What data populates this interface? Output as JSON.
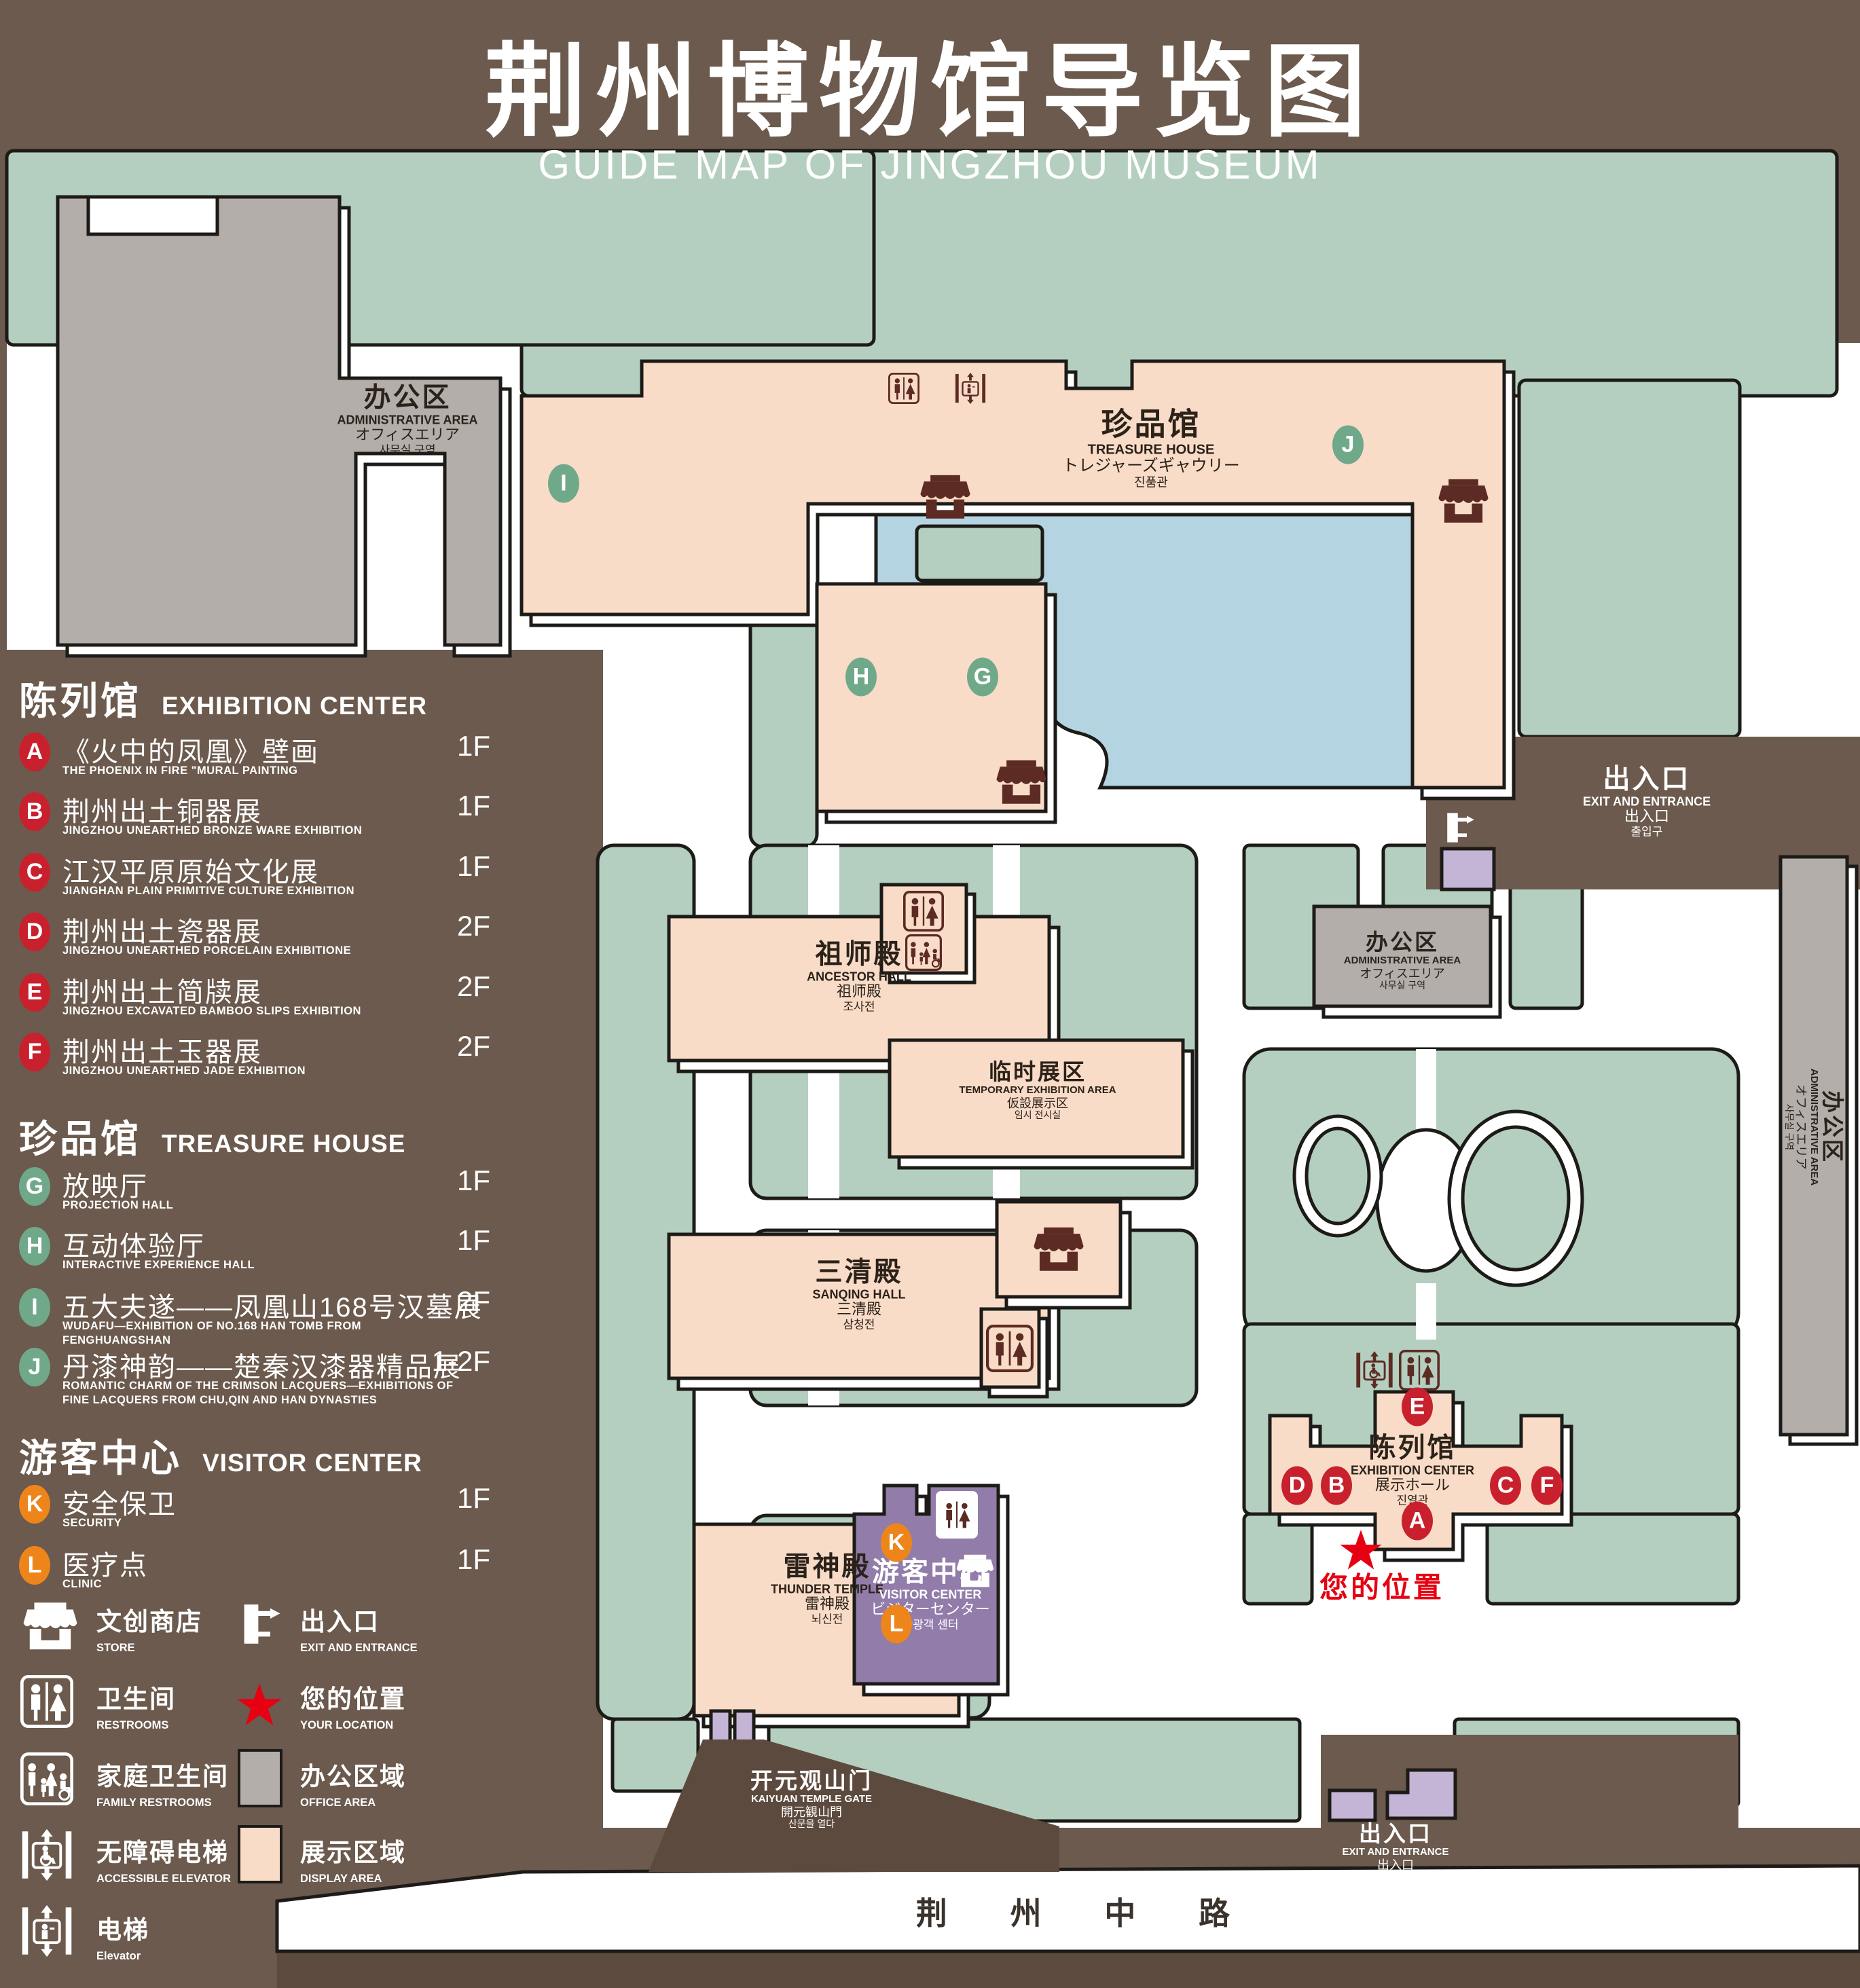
{
  "title": {
    "zh": "荆州博物馆导览图",
    "en": "GUIDE MAP OF JINGZHOU MUSEUM"
  },
  "legend": {
    "sections": [
      {
        "zh": "陈列馆",
        "en": "EXHIBITION CENTER",
        "items": [
          {
            "letter": "A",
            "zh": "《火中的凤凰》壁画",
            "en": "THE PHOENIX IN FIRE \"MURAL PAINTING",
            "floor": "1F"
          },
          {
            "letter": "B",
            "zh": "荆州出土铜器展",
            "en": "JINGZHOU UNEARTHED BRONZE WARE EXHIBITION",
            "floor": "1F"
          },
          {
            "letter": "C",
            "zh": "江汉平原原始文化展",
            "en": "JIANGHAN PLAIN PRIMITIVE CULTURE EXHIBITION",
            "floor": "1F"
          },
          {
            "letter": "D",
            "zh": "荆州出土瓷器展",
            "en": "JINGZHOU UNEARTHED PORCELAIN EXHIBITIONE",
            "floor": "2F"
          },
          {
            "letter": "E",
            "zh": "荆州出土简牍展",
            "en": "JINGZHOU EXCAVATED BAMBOO SLIPS EXHIBITION",
            "floor": "2F"
          },
          {
            "letter": "F",
            "zh": "荆州出土玉器展",
            "en": "JINGZHOU UNEARTHED JADE EXHIBITION",
            "floor": "2F"
          }
        ]
      },
      {
        "zh": "珍品馆",
        "en": "TREASURE HOUSE",
        "items": [
          {
            "letter": "G",
            "zh": "放映厅",
            "en": "PROJECTION HALL",
            "floor": "1F"
          },
          {
            "letter": "H",
            "zh": "互动体验厅",
            "en": "INTERACTIVE EXPERIENCE HALL",
            "floor": "1F"
          },
          {
            "letter": "I",
            "zh": "五大夫遂——凤凰山168号汉墓展",
            "en": "WUDAFU—EXHIBITION OF NO.168 HAN TOMB FROM FENGHUANGSHAN",
            "floor": "2F"
          },
          {
            "letter": "J",
            "zh": "丹漆神韵——楚秦汉漆器精品展",
            "en": "ROMANTIC CHARM OF THE CRIMSON LACQUERS—EXHIBITIONS OF FINE LACQUERS FROM CHU,QIN AND HAN DYNASTIES",
            "floor": "1-2F"
          }
        ]
      },
      {
        "zh": "游客中心",
        "en": "VISITOR CENTER",
        "items": [
          {
            "letter": "K",
            "zh": "安全保卫",
            "en": "SECURITY",
            "floor": "1F"
          },
          {
            "letter": "L",
            "zh": "医疗点",
            "en": "CLINIC",
            "floor": "1F"
          }
        ]
      }
    ],
    "symbols": {
      "store": {
        "zh": "文创商店",
        "en": "STORE"
      },
      "exit": {
        "zh": "出入口",
        "en": "EXIT AND ENTRANCE"
      },
      "restroom": {
        "zh": "卫生间",
        "en": "RESTROOMS"
      },
      "location": {
        "zh": "您的位置",
        "en": "YOUR LOCATION"
      },
      "family": {
        "zh": "家庭卫生间",
        "en": "FAMILY RESTROOMS"
      },
      "office": {
        "zh": "办公区域",
        "en": "OFFICE AREA"
      },
      "accessible_elevator": {
        "zh": "无障碍电梯",
        "en": "ACCESSIBLE ELEVATOR"
      },
      "display": {
        "zh": "展示区域",
        "en": "DISPLAY AREA"
      },
      "elevator": {
        "zh": "电梯",
        "en": "Elevator"
      }
    }
  },
  "map": {
    "buildings": {
      "admin": {
        "zh": "办公区",
        "en": "ADMINISTRATIVE AREA",
        "ja": "オフィスエリア",
        "ko": "사무실 구역"
      },
      "treasure": {
        "zh": "珍品馆",
        "en": "TREASURE HOUSE",
        "ja": "トレジャーズギャウリー",
        "ko": "진품관"
      },
      "ancestor": {
        "zh": "祖师殿",
        "en": "ANCESTOR HALL",
        "ja": "祖师殿",
        "ko": "조사전"
      },
      "temporary": {
        "zh": "临时展区",
        "en": "TEMPORARY EXHIBITION AREA",
        "ja": "仮設展示区",
        "ko": "임시 전시실"
      },
      "sanqing": {
        "zh": "三清殿",
        "en": "SANQING HALL",
        "ja": "三清殿",
        "ko": "삼청전"
      },
      "thunder": {
        "zh": "雷神殿",
        "en": "THUNDER TEMPLE",
        "ja": "雷神殿",
        "ko": "뇌신전"
      },
      "visitor": {
        "zh": "游客中心",
        "en": "VISITOR CENTER",
        "ja": "ビジターセンター",
        "ko": "관광객 센터"
      },
      "exhibition": {
        "zh": "陈列馆",
        "en": "EXHIBITION CENTER",
        "ja": "展示ホール",
        "ko": "진열관"
      },
      "gate": {
        "zh": "开元观山门",
        "en": "KAIYUAN TEMPLE GATE",
        "ja": "開元観山門",
        "ko": "산문을 열다"
      },
      "exit": {
        "zh": "出入口",
        "en": "EXIT AND ENTRANCE",
        "ja": "出入口",
        "ko": "출입구"
      },
      "your_location": {
        "zh": "您的位置"
      },
      "road": {
        "zh": "荆 州 中 路"
      }
    }
  },
  "colors": {
    "background": "#6b5a4d",
    "dark_brown": "#5d4a3e",
    "lawn_green": "#b4cfbf",
    "display_pink": "#f9dcc8",
    "office_gray": "#b3aeaa",
    "pond_blue": "#b5d4e2",
    "visitor_purple": "#917caa",
    "gate_lavender": "#c4b4d6",
    "marker_red": "#c9202e",
    "marker_green": "#6fa98a",
    "marker_orange": "#ee851b",
    "location_red": "#e60012",
    "outline": "#1d1b18",
    "icon_maroon": "#5c2b23"
  }
}
